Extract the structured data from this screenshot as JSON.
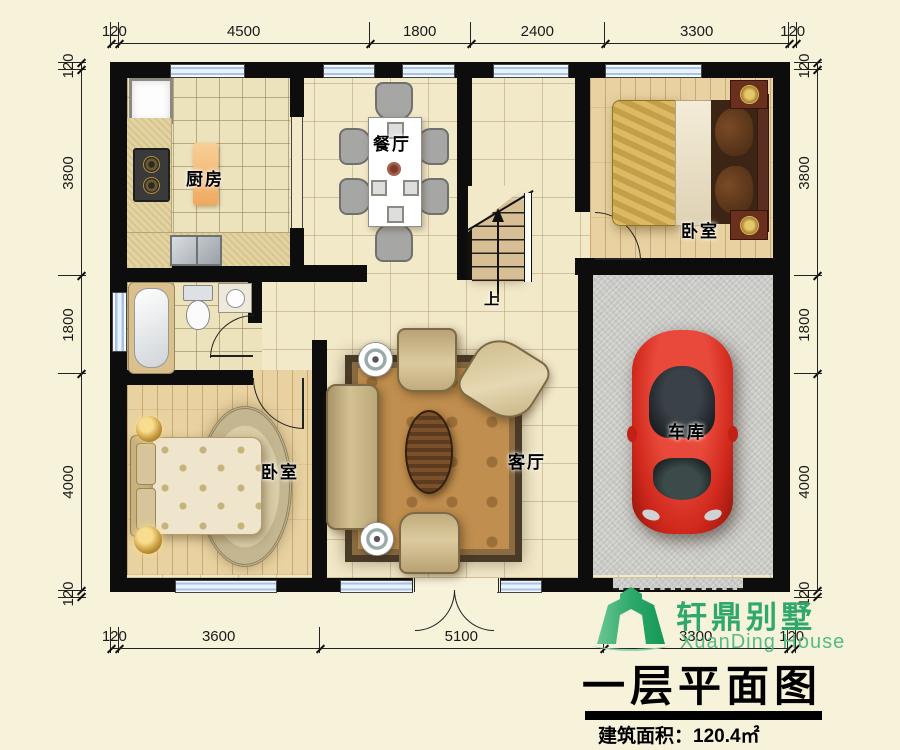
{
  "dimensions": {
    "top": [
      120,
      4500,
      1800,
      2400,
      3300,
      120
    ],
    "bottom": [
      120,
      3600,
      5100,
      3300,
      120
    ],
    "left": [
      120,
      3800,
      1800,
      4000,
      120
    ],
    "right": [
      120,
      3800,
      1800,
      4000,
      120
    ]
  },
  "rooms": {
    "kitchen": "厨房",
    "dining": "餐厅",
    "bedroom_top_right": "卧室",
    "bedroom_bottom_left": "卧室",
    "living": "客厅",
    "garage": "车库",
    "stairs_up": "上"
  },
  "title_block": {
    "brand": "轩鼎别墅",
    "brand_en": "XuanDing House",
    "plan_title": "一层平面图",
    "area_text": "建筑面积：120.4㎡"
  },
  "colors": {
    "background": "#f7f2da",
    "wall": "#0d0d0d",
    "window_blue": "#a7c4e2",
    "logo_green": "#2ea96b",
    "car_red": "#d0281c",
    "rug_field": "#c08e4e"
  }
}
